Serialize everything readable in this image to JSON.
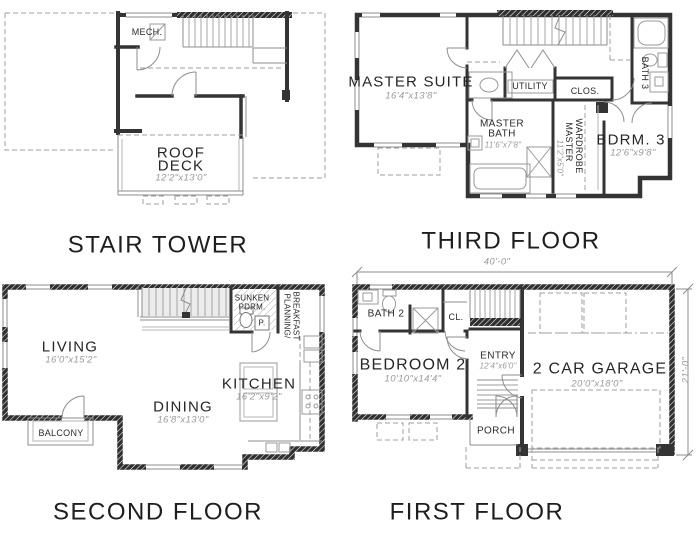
{
  "colors": {
    "wall": "#343434",
    "thin_line": "#8d8d8d",
    "dashed_line": "#9f9f9f",
    "dim_text": "#9a9a9a",
    "label_text": "#262626",
    "title_text": "#1e1e1e",
    "background": "#ffffff"
  },
  "plans": {
    "stair_tower": {
      "title": "STAIR TOWER",
      "labels": {
        "mech": "MECH.",
        "roof_line1": "ROOF",
        "roof_line2": "DECK",
        "roof_dims": "12'2\"x13'0\""
      }
    },
    "third_floor": {
      "title": "THIRD FLOOR",
      "labels": {
        "master_suite": "MASTER SUITE",
        "master_suite_dims": "16'4\"x13'8\"",
        "utility": "UTILITY",
        "closet": "CLOS.",
        "bath3": "BATH 3",
        "master_bath_line1": "MASTER",
        "master_bath_line2": "BATH",
        "master_bath_dims": "11'6\"x7'8\"",
        "wardrobe_line1": "MASTER",
        "wardrobe_line2": "WARDROBE",
        "wardrobe_dims": "11'2\"x5'0\"",
        "bedroom3": "BDRM. 3",
        "bedroom3_dims": "12'6\"x9'8\""
      }
    },
    "second_floor": {
      "title": "SECOND FLOOR",
      "labels": {
        "living": "LIVING",
        "living_dims": "16'0\"x15'2\"",
        "dining": "DINING",
        "dining_dims": "16'8\"x13'0\"",
        "kitchen": "KITCHEN",
        "kitchen_dims": "16'2\"x9'2\"",
        "balcony": "BALCONY",
        "sunken_line1": "SUNKEN",
        "sunken_line2": "PDRM.",
        "powder": "P.",
        "planning_line1": "PLANNING/",
        "planning_line2": "BREAKFAST"
      }
    },
    "first_floor": {
      "title": "FIRST FLOOR",
      "dimensions": {
        "width": "40'-0\"",
        "depth": "21'-0\""
      },
      "labels": {
        "bath2": "BATH 2",
        "closet": "CL.",
        "bedroom2": "BEDROOM 2",
        "bedroom2_dims": "10'10\"x14'4\"",
        "entry": "ENTRY",
        "entry_dims": "12'4\"x6'0\"",
        "garage": "2 CAR GARAGE",
        "garage_dims": "20'0\"x18'0\"",
        "porch": "PORCH"
      }
    }
  }
}
